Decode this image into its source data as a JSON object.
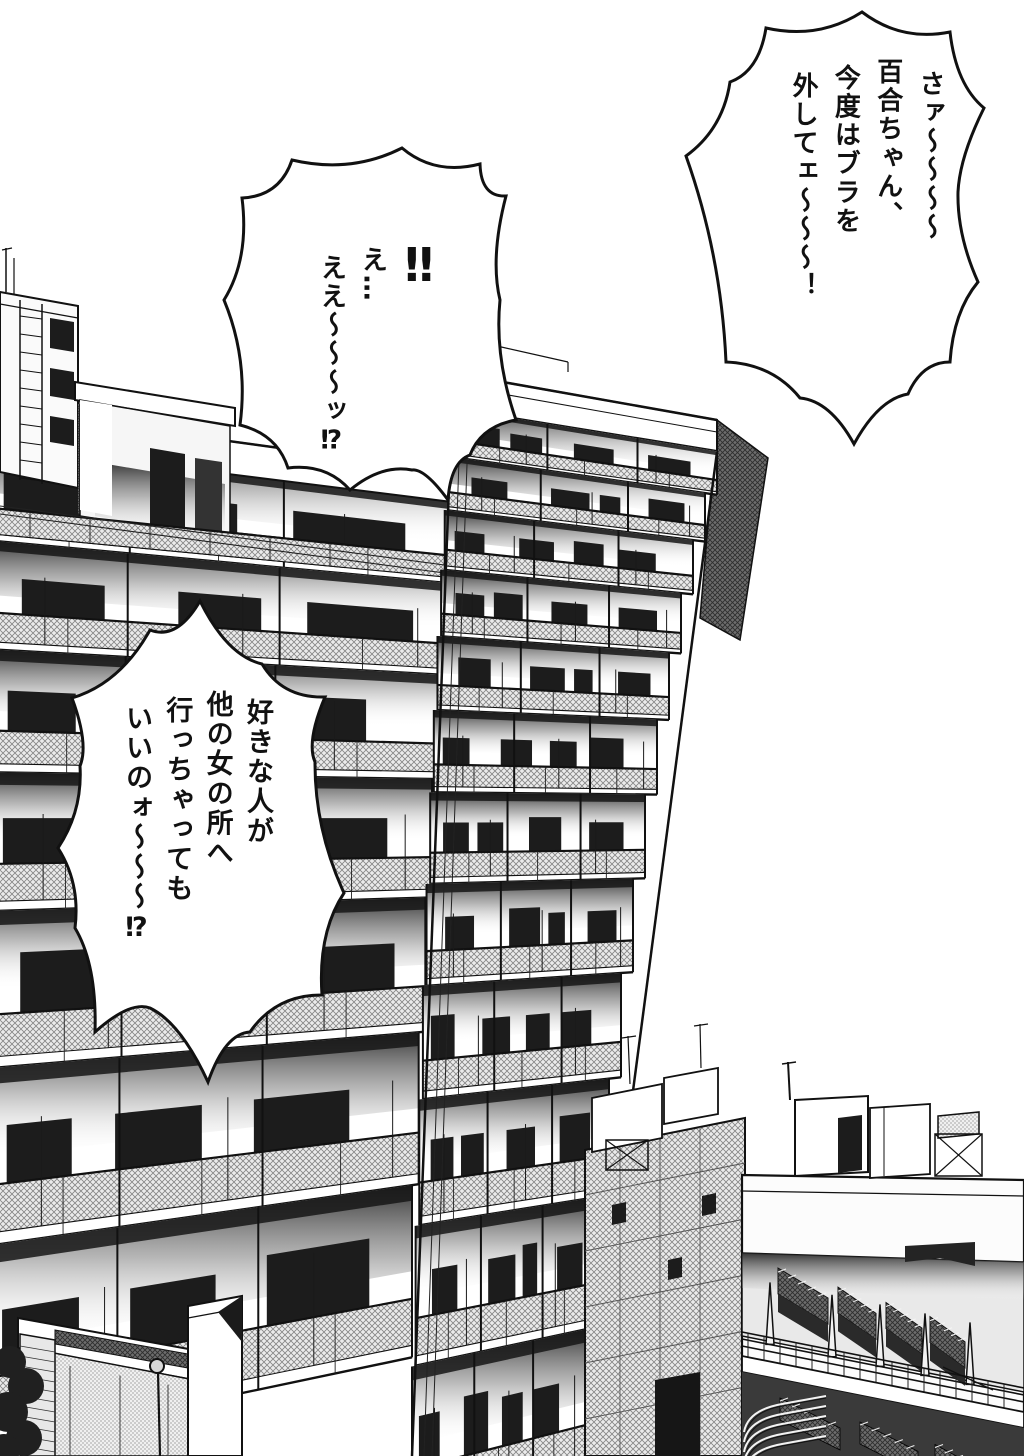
{
  "speech_bubbles": [
    {
      "id": "bubble-top-right",
      "columns": [
        "さァ〜〜〜〜",
        "百合ちゃん、",
        "今度はブラを",
        "外してェ〜〜〜！"
      ]
    },
    {
      "id": "bubble-exclamation",
      "columns": [
        "‼",
        "え…",
        "ええ〜〜〜ッ⁉"
      ]
    },
    {
      "id": "bubble-question",
      "columns": [
        "好きな人が",
        "他の女の所へ",
        "行っちゃっても",
        "いいのォ〜〜〜⁉"
      ]
    }
  ],
  "colors": {
    "ink": "#111111",
    "paper": "#ffffff",
    "window_dark": "#1c1c1c",
    "railing_hatch": "#8a8a8a",
    "shadow_dark": "#2a2a2a"
  }
}
